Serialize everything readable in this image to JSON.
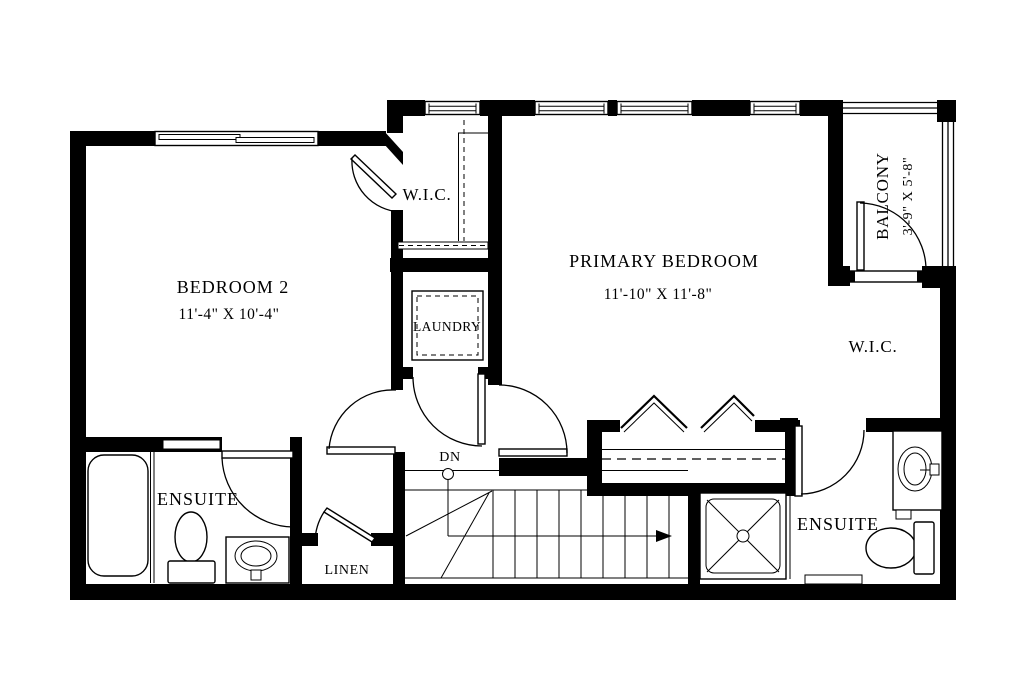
{
  "colors": {
    "wall": "#000000",
    "background": "#ffffff"
  },
  "rooms": {
    "bedroom2": {
      "label": "BEDROOM 2",
      "dims": "11'-4\" X 10'-4\""
    },
    "primary_bedroom": {
      "label": "PRIMARY BEDROOM",
      "dims": "11'-10\" X 11'-8\""
    },
    "balcony": {
      "label": "BALCONY",
      "dims": "3'-9\" X 5'-8\""
    },
    "wic_upper": {
      "label": "W.I.C."
    },
    "wic_right": {
      "label": "W.I.C."
    },
    "laundry": {
      "label": "LAUNDRY"
    },
    "ensuite_left": {
      "label": "ENSUITE"
    },
    "ensuite_right": {
      "label": "ENSUITE"
    },
    "linen": {
      "label": "LINEN"
    }
  },
  "stairs": {
    "down_label": "DN"
  }
}
